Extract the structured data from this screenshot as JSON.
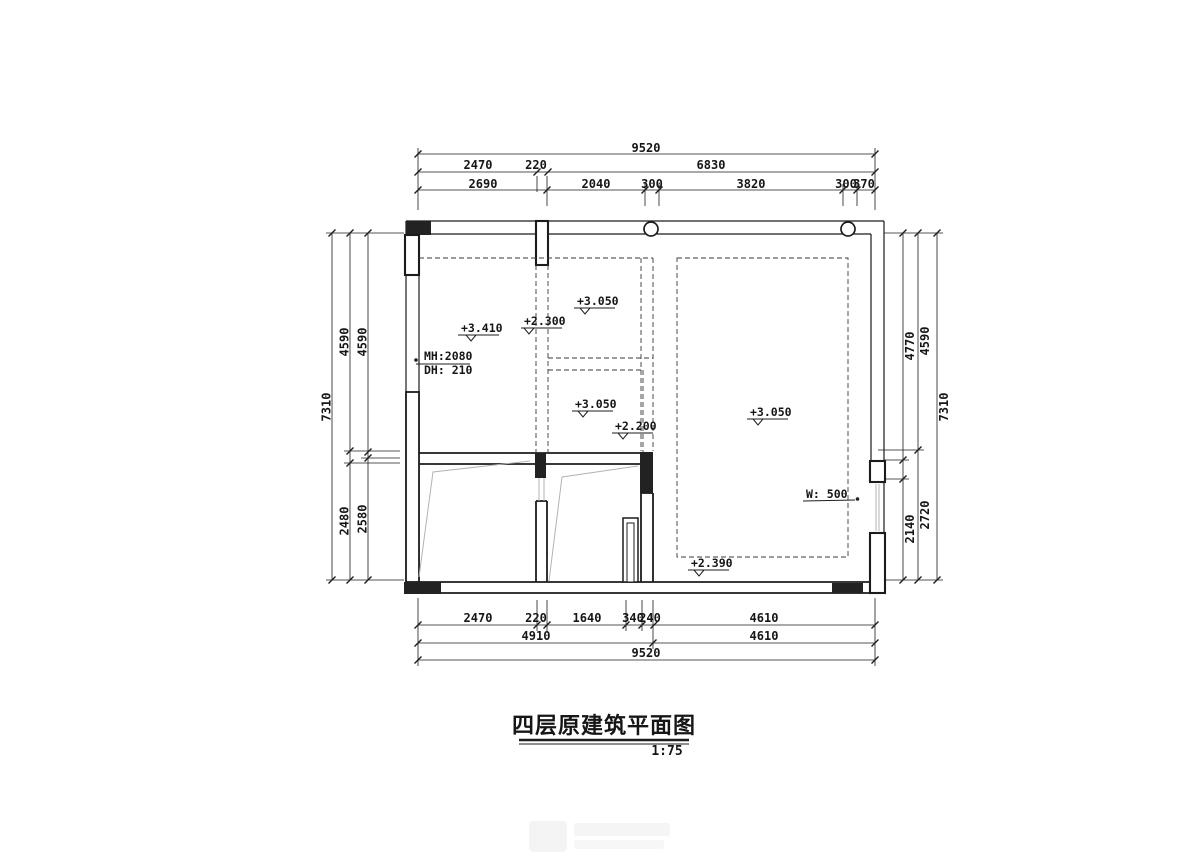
{
  "title": {
    "text": "四层原建筑平面图",
    "scale": "1:75"
  },
  "dims": {
    "top_row1": [
      "9520"
    ],
    "top_row2": [
      "2470",
      "220",
      "6830"
    ],
    "top_row3": [
      "2690",
      "2040",
      "300",
      "3820",
      "300",
      "370"
    ],
    "bottom_row1": [
      "2470",
      "220",
      "1640",
      "340",
      "240",
      "4610"
    ],
    "bottom_row2": [
      "4910",
      "4610"
    ],
    "bottom_row3": [
      "9520"
    ],
    "left_outer": "7310",
    "left_mid_top": "4590",
    "left_mid_bottom": "2480",
    "left_inner_top": "4590",
    "left_inner_bottom": "2580",
    "right_inner_top": "4770",
    "right_inner_bottom": "2140",
    "right_mid_top": "4590",
    "right_mid_bottom": "2720",
    "right_outer": "7310"
  },
  "labels": {
    "elev_a": "+3.410",
    "elev_b": "+2.300",
    "elev_c": "+3.050",
    "elev_d": "+3.050",
    "elev_e": "+2.200",
    "elev_f": "+3.050",
    "elev_g": "+2.390",
    "mh": "MH:2080",
    "dh": "DH: 210",
    "w": "W: 500"
  },
  "colors": {
    "line": "#1c1c1c",
    "light_line": "#b3b3b3",
    "background": "#ffffff"
  }
}
